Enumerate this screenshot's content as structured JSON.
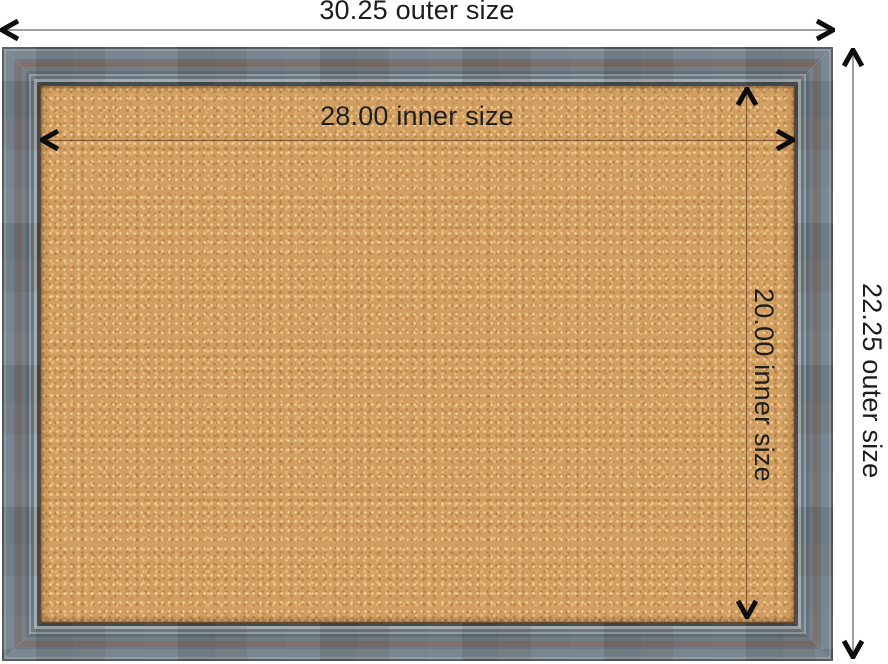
{
  "canvas": {
    "background": "#ffffff",
    "width_px": 888,
    "height_px": 664
  },
  "annotations": {
    "outer_width": "30.25 outer size",
    "inner_width": "28.00 inner size",
    "outer_height": "22.25 outer size",
    "inner_height": "20.00 inner size"
  },
  "board": {
    "frame_colors": {
      "gray_blue": "#73828c",
      "brown_accent": "#786a66",
      "lip_highlight": "#a0a9ae",
      "edge_dark": "#4d575d"
    },
    "cork_colors": {
      "base": "#d29f62",
      "light_fleck": "#eec48e",
      "dark_fleck": "#b07f46"
    }
  },
  "dimension_style": {
    "outer_line_color": "#a0a0a0",
    "inner_line_color": "rgba(88,54,20,0.65)",
    "arrow_color": "#0d0d0d",
    "label_color": "#1c1c1c"
  }
}
